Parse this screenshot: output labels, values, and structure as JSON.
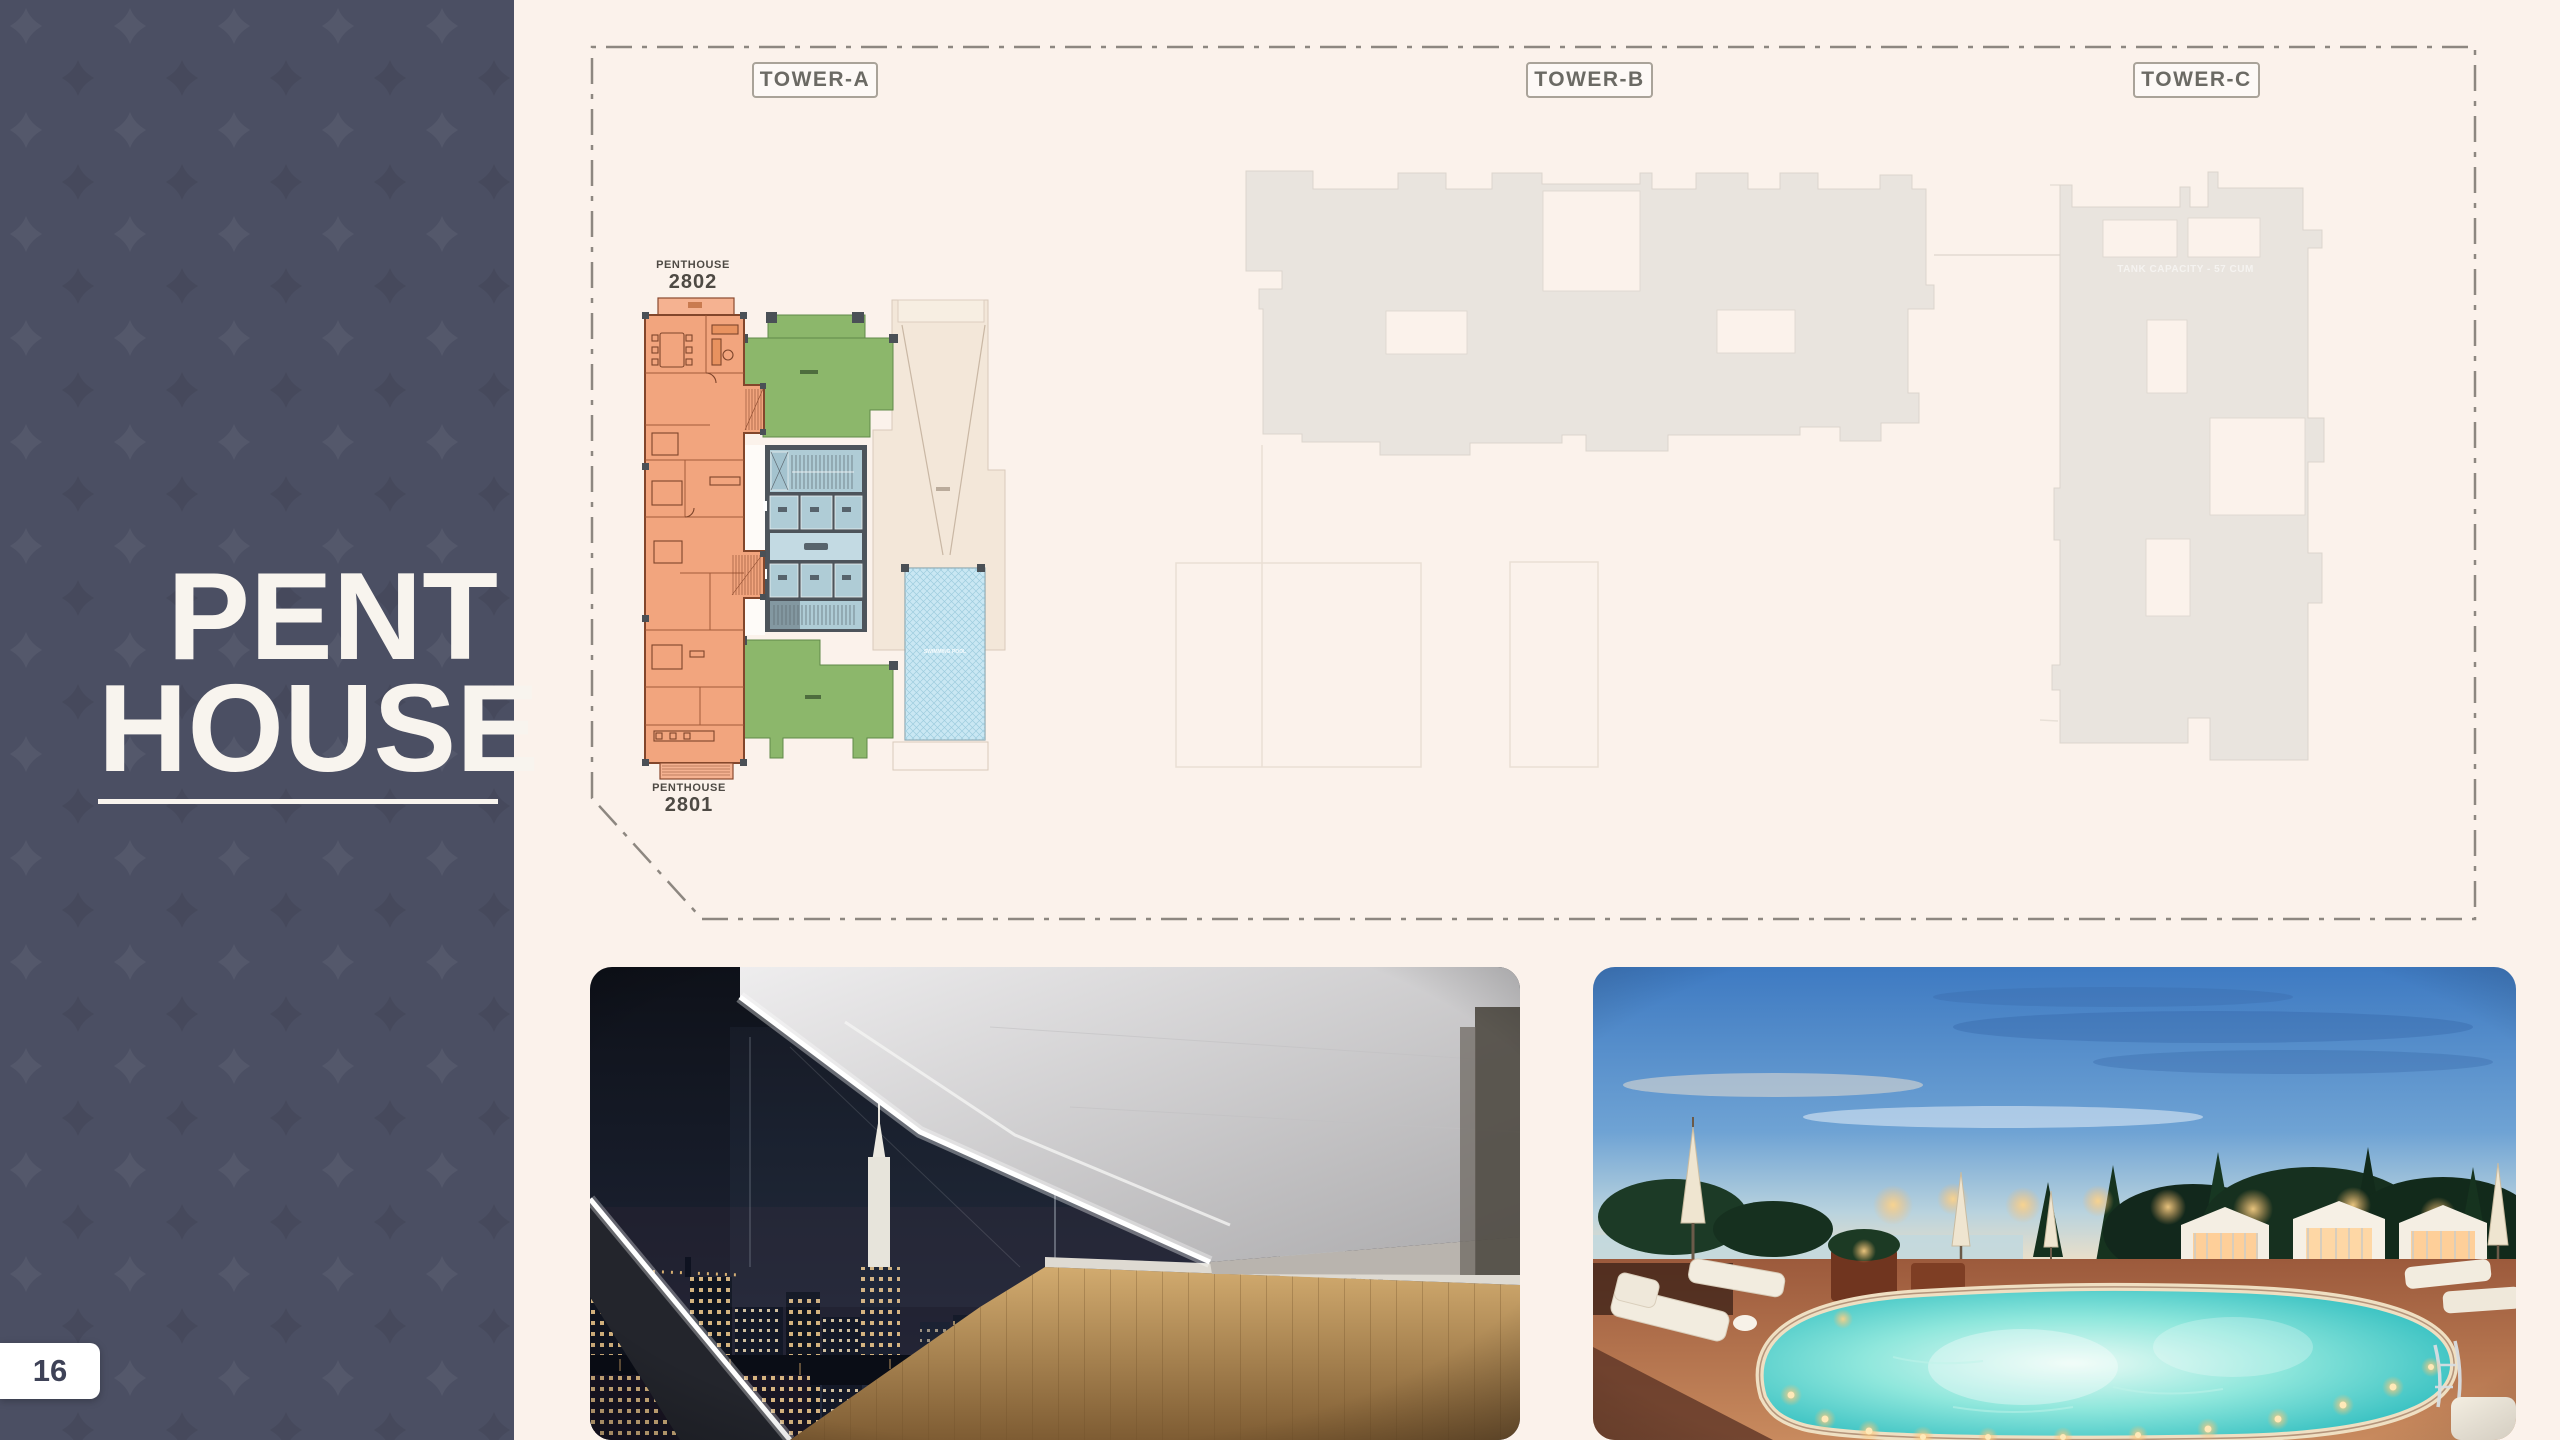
{
  "sidebar": {
    "title_line1": "PENT",
    "title_line2": "HOUSE",
    "page_number": "16"
  },
  "site_plan": {
    "tower_labels": [
      {
        "label": "TOWER-A"
      },
      {
        "label": "TOWER-B"
      },
      {
        "label": "TOWER-C"
      }
    ],
    "units": {
      "top": {
        "name": "PENTHOUSE",
        "number": "2802"
      },
      "bottom": {
        "name": "PENTHOUSE",
        "number": "2801"
      }
    },
    "pool_label": "SWIMMING POOL",
    "tower_c_note": "TANK CAPACITY - 57 CUM"
  },
  "colors": {
    "sidebar_bg": "#4B4F63",
    "canvas_bg": "#FBF2EB",
    "unit_orange": "#F2A57E",
    "terrace_green": "#8CB76B",
    "core_blue": "#AFCCD6",
    "pool_blue": "#C9E7F3",
    "tower_silhouette": "#E9E4DE",
    "boundary_dash": "#8D8780",
    "title_text": "#F8F4EE"
  }
}
